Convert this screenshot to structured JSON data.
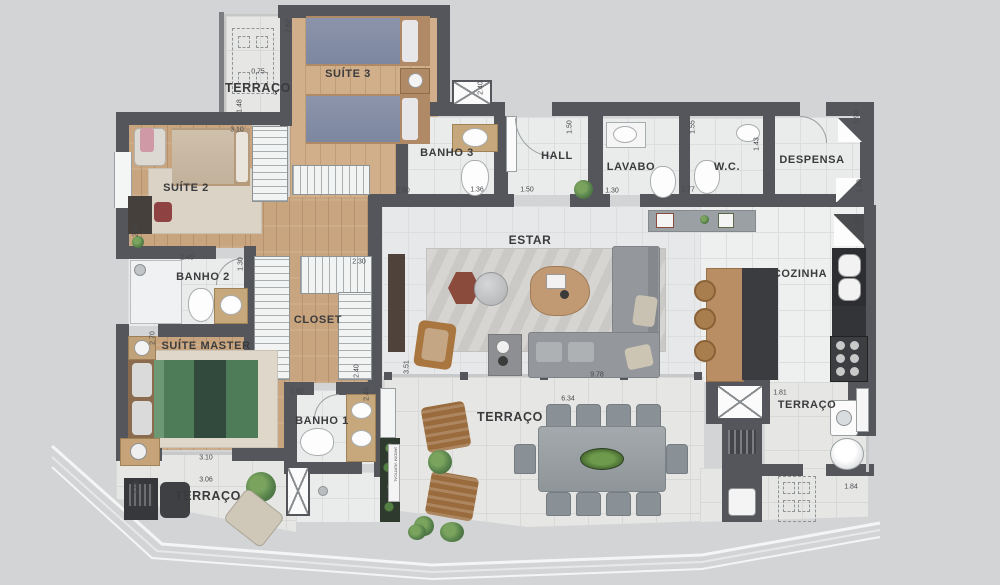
{
  "rooms": {
    "terraco_tl": "TERRAÇO",
    "suite3": "SUÍTE 3",
    "suite2": "SUÍTE 2",
    "banho3": "BANHO 3",
    "hall": "HALL",
    "lavabo": "LAVABO",
    "wc": "W.C.",
    "despensa": "DESPENSA",
    "estar": "ESTAR",
    "cozinha": "COZINHA",
    "banho2": "BANHO 2",
    "closet": "CLOSET",
    "suite_master": "SUÍTE MASTER",
    "banho1": "BANHO 1",
    "terraco_bl": "TERRAÇO",
    "terraco_bm": "TERRAÇO",
    "terraco_r": "TERRAÇO"
  },
  "dims": [
    "0.75",
    "2.62",
    "1.48",
    "3.10",
    "2.50",
    "2.50",
    "2.40",
    "1.50",
    "1.55",
    "1.36",
    "1.50",
    "1.30",
    "1.77",
    "1.43",
    "1.90",
    "1.50",
    "3.56",
    "2.40",
    "1.30",
    "2.30",
    "2.70",
    "2.40",
    "3.51",
    "1.85",
    "2.45",
    "9.78",
    "6.34",
    "3.10",
    "3.06",
    "1.06",
    "1.81",
    "1.84"
  ],
  "labels": {
    "jardim": "JARDIM VERTICAL"
  },
  "colors": {
    "wall": "#55565b",
    "wood_floor": "#c9a57f",
    "tile_floor": "#eaebeb",
    "bed_green": "#4f7c58",
    "bed_blue": "#8b94aa",
    "sofa_gray": "#94979b",
    "plant_green": "#55804a",
    "background": "#d3d4d6"
  }
}
